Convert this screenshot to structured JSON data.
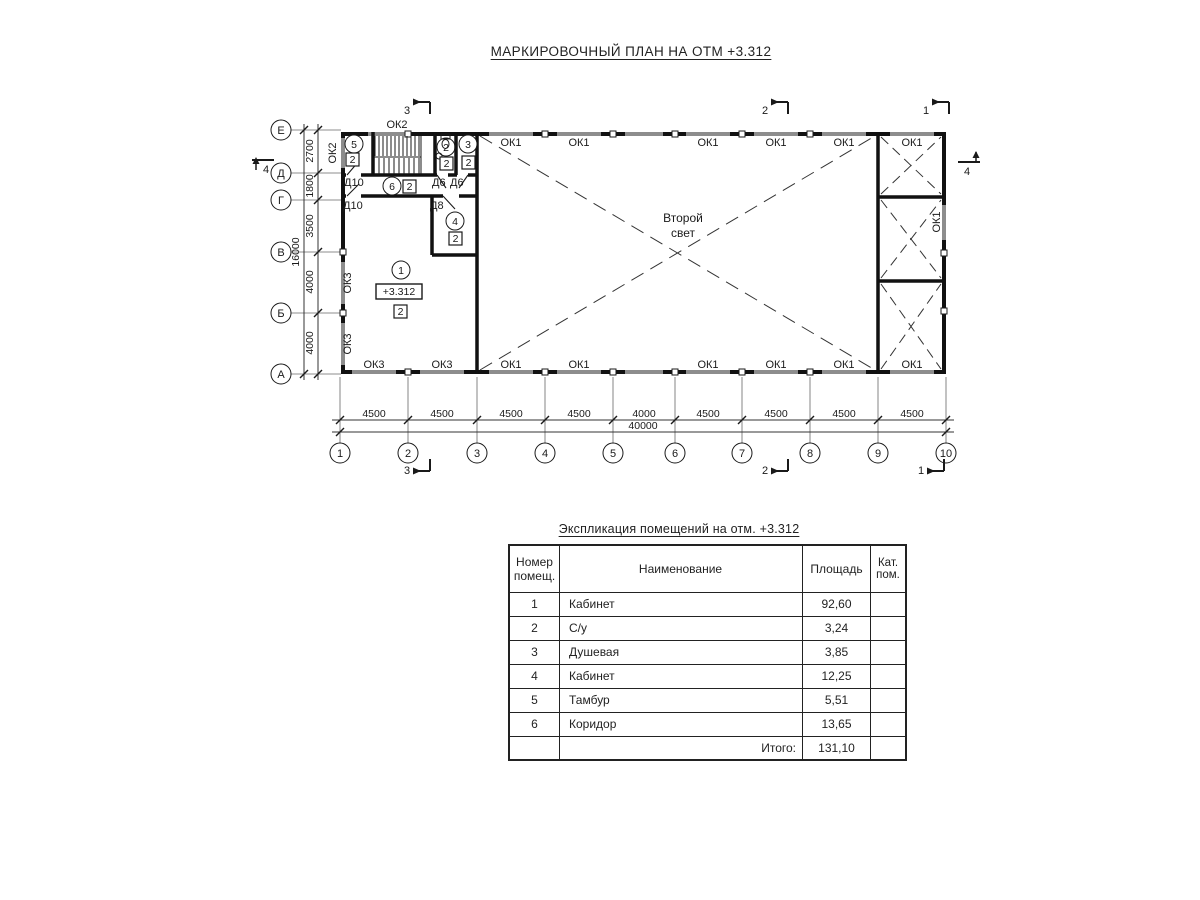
{
  "page": {
    "title": "МАРКИРОВОЧНЫЙ ПЛАН НА ОТМ +3.312"
  },
  "plan": {
    "grid_cols": [
      "1",
      "2",
      "3",
      "4",
      "5",
      "6",
      "7",
      "8",
      "9",
      "10"
    ],
    "grid_rows": [
      "Е",
      "Д",
      "Г",
      "В",
      "Б",
      "А"
    ],
    "dim_spans": [
      "4500",
      "4500",
      "4500",
      "4500",
      "4000",
      "4500",
      "4500",
      "4500",
      "4500"
    ],
    "dim_total": "40000",
    "dim_left_spans": [
      "2700",
      "1800",
      "3500",
      "4000",
      "4000"
    ],
    "dim_left_total": "16000",
    "win_top": [
      "ОК2",
      "ОК1",
      "ОК1",
      "ОК1",
      "ОК1",
      "ОК1",
      "ОК1"
    ],
    "win_bottom": [
      "ОК3",
      "ОК3",
      "ОК1",
      "ОК1",
      "ОК1",
      "ОК1",
      "ОК1",
      "ОК1"
    ],
    "win_left": [
      "ОК2",
      "ОК3",
      "ОК3"
    ],
    "win_right": [
      "ОК1"
    ],
    "doors": [
      "Д10",
      "Д10",
      "Д6",
      "Д6",
      "Д8"
    ],
    "rooms": [
      {
        "num": "1",
        "cat": "2"
      },
      {
        "num": "2",
        "cat": "2"
      },
      {
        "num": "3",
        "cat": "2"
      },
      {
        "num": "4",
        "cat": "2"
      },
      {
        "num": "5",
        "cat": "2"
      },
      {
        "num": "6",
        "cat": "2"
      }
    ],
    "elevation": "+3.312",
    "second_light": {
      "line1": "Второй",
      "line2": "свет"
    },
    "sections": {
      "one": "1",
      "two": "2",
      "three": "3",
      "four": "4"
    }
  },
  "table": {
    "title": "Экспликация помещений на отм. +3.312",
    "headers": {
      "num1": "Номер",
      "num2": "помещ.",
      "name": "Наименование",
      "area": "Площадь",
      "cat1": "Кат.",
      "cat2": "пом."
    },
    "rows": [
      {
        "num": "1",
        "name": "Кабинет",
        "area": "92,60"
      },
      {
        "num": "2",
        "name": "С/у",
        "area": "3,24"
      },
      {
        "num": "3",
        "name": "Душевая",
        "area": "3,85"
      },
      {
        "num": "4",
        "name": "Кабинет",
        "area": "12,25"
      },
      {
        "num": "5",
        "name": "Тамбур",
        "area": "5,51"
      },
      {
        "num": "6",
        "name": "Коридор",
        "area": "13,65"
      }
    ],
    "total_label": "Итого:",
    "total_value": "131,10"
  }
}
